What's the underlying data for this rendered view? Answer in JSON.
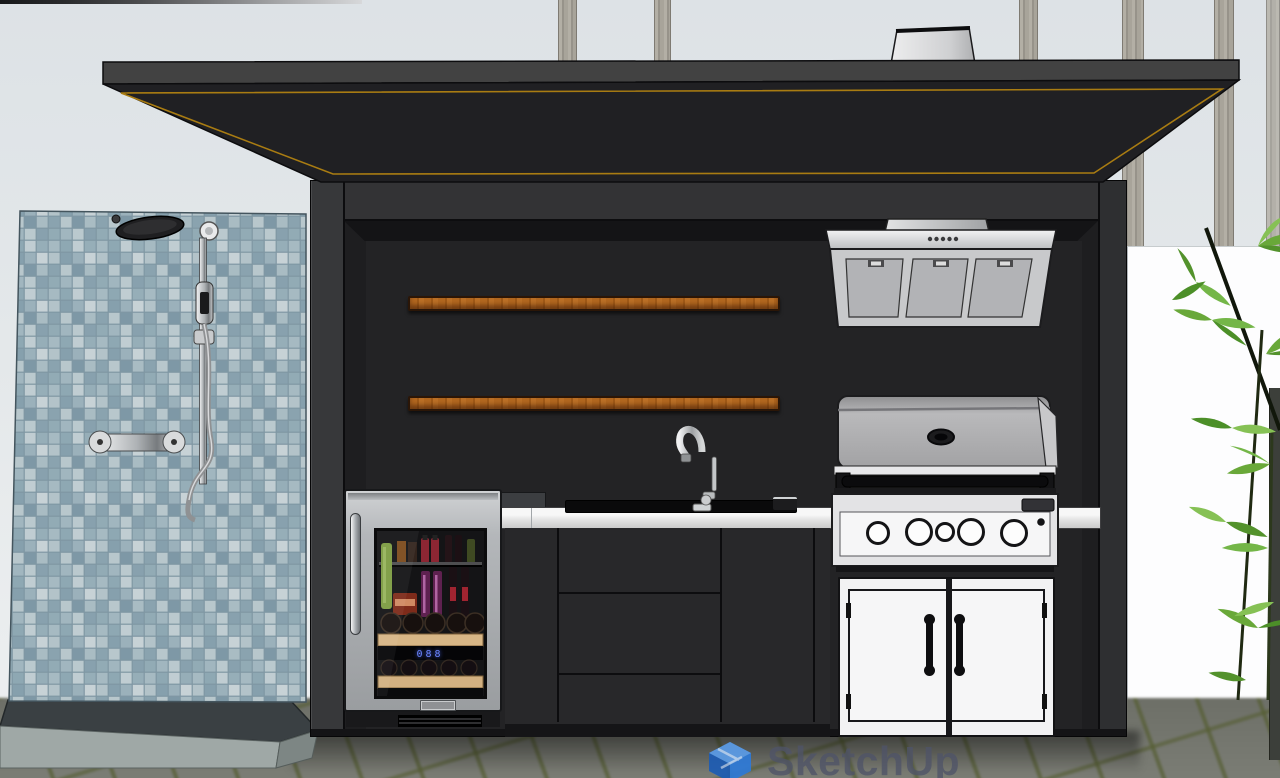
{
  "app": {
    "name": "SketchUp",
    "watermark_text": "SketchUp"
  },
  "fridge": {
    "led_display": "088"
  },
  "scene": {
    "description": "3D model viewport: black outdoor kitchen pavilion with cantilevered flat roof, wood shelves, range hood, sink, gas grill, beverage fridge, white access doors, and an outdoor shower on a blue mosaic tile wall; bamboo and white fence at right; paver ground",
    "colors": {
      "sky": "#e3e7ea",
      "roof_fascia": "#424242",
      "roof_soffit": "#202023",
      "roof_trim_gold": "#a97c12",
      "structure": "#2c2c2e",
      "alcove": "#1e1e20",
      "shelf_wood": "#b2671f",
      "tile_wall": "#9db3bd",
      "platform_curb": "#9fa8a6",
      "paver": "#74766e",
      "paver_joint": "#5b6240",
      "white_wall": "#fdfdfe",
      "stainless": "#c3c6c8",
      "grill_body": "#ababad",
      "door_white": "#f2f2f3",
      "counter": "#ececec",
      "bamboo_green": "#69a839",
      "led_blue": "#6d86ff",
      "watermark_blue": "#2e7ad8",
      "watermark_text": "#4f5468"
    }
  }
}
